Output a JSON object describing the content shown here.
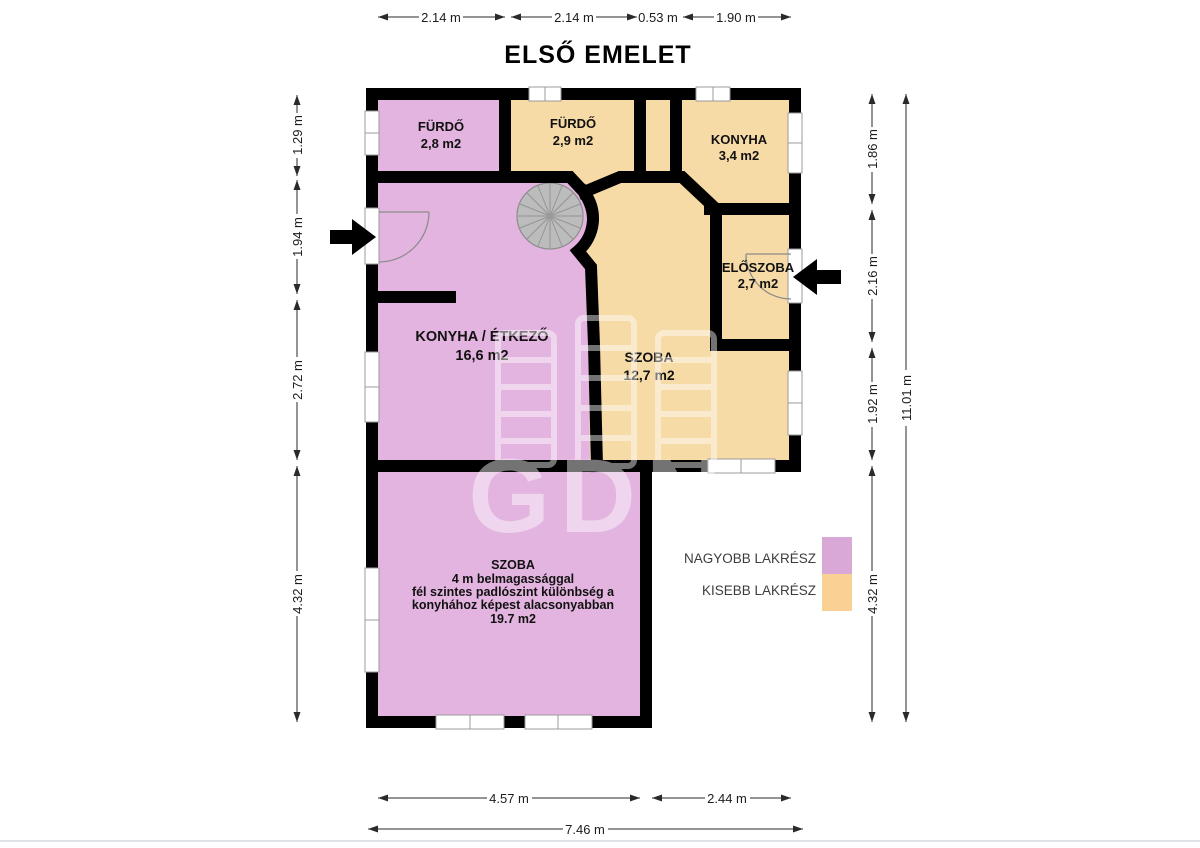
{
  "title": "ELSŐ EMELET",
  "watermark": "GDN",
  "rooms": {
    "furdo1": {
      "name": "FÜRDŐ",
      "area": "2,8 m2"
    },
    "furdo2": {
      "name": "FÜRDŐ",
      "area": "2,9 m2"
    },
    "konyha": {
      "name": "KONYHA",
      "area": "3,4 m2"
    },
    "eloszoba": {
      "name": "ELŐSZOBA",
      "area": "2,7 m2"
    },
    "konyha_etkezo": {
      "name": "KONYHA / ÉTKEZŐ",
      "area": "16,6 m2"
    },
    "szoba": {
      "name": "SZOBA",
      "area": "12,7 m2"
    },
    "also_szoba": {
      "line1": "SZOBA",
      "line2": "4 m belmagassággal",
      "line3": "fél szintes padlószint különbség a",
      "line4": "konyhához képest alacsonyabban",
      "line5": "19.7 m2"
    }
  },
  "legend": {
    "items": [
      {
        "label": "NAGYOBB LAKRÉSZ",
        "color": "#d9a8d6"
      },
      {
        "label": "KISEBB LAKRÉSZ",
        "color": "#fbd095"
      }
    ]
  },
  "dimensions": {
    "top": [
      "2.14 m",
      "2.14 m",
      "0.53 m",
      "1.90 m"
    ],
    "left": [
      "1.29 m",
      "1.94 m",
      "2.72 m",
      "4.32 m"
    ],
    "right": [
      "1.86 m",
      "2.16 m",
      "1.92 m",
      "4.32 m"
    ],
    "right_total": "11.01 m",
    "bottom": [
      "4.57 m",
      "2.44 m"
    ],
    "bottom_total": "7.46 m"
  },
  "colors": {
    "larger_unit": "#e3b4df",
    "smaller_unit": "#f7dba7",
    "wall": "#000000",
    "stairs": "#bcbcbc"
  }
}
